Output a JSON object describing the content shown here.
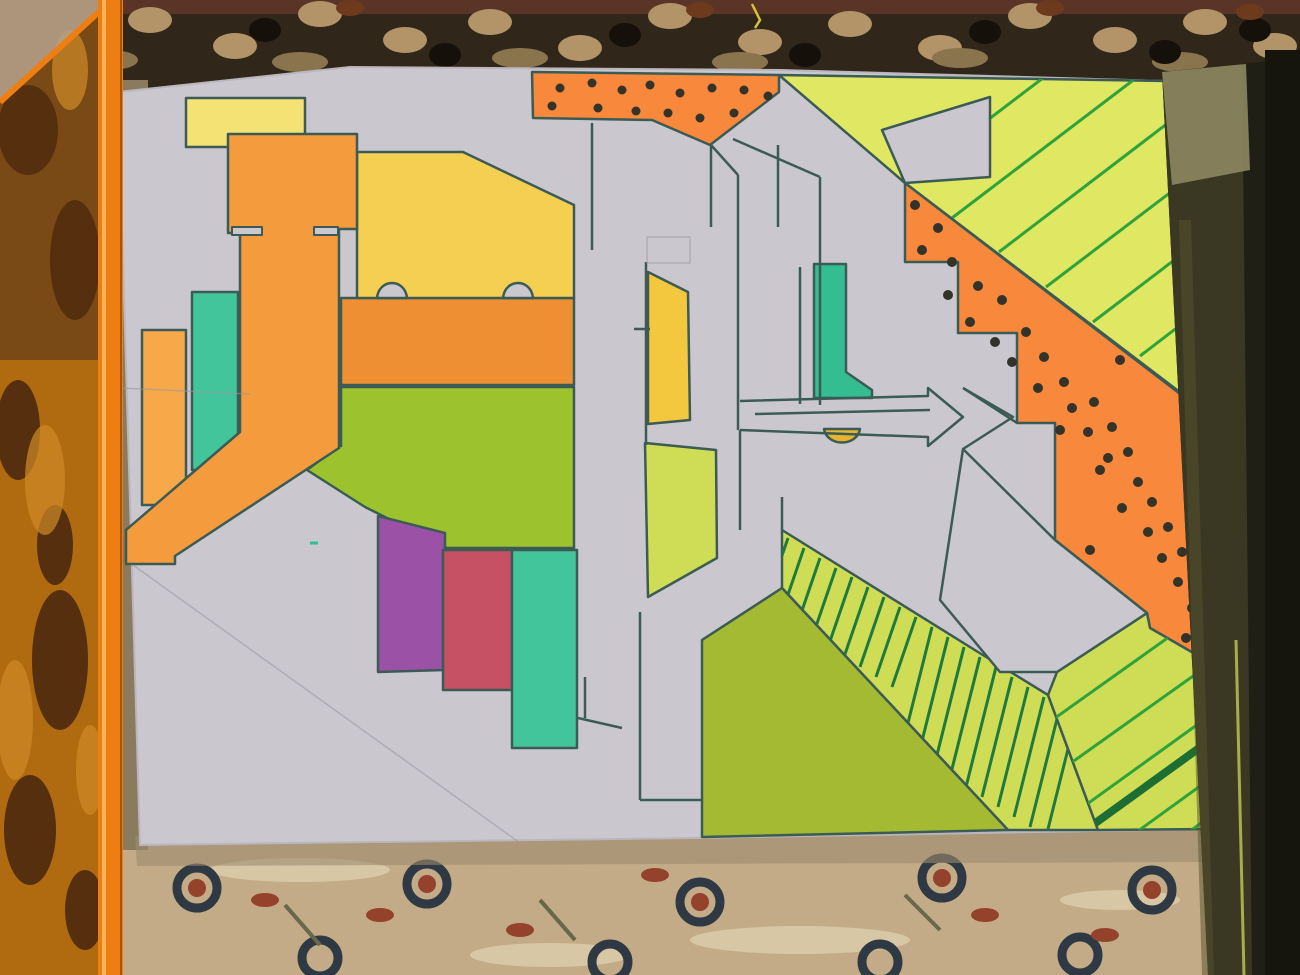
{
  "scene": {
    "type": "photograph",
    "subject": "hand-drawn abstract graffiti-style marker artwork on a white sheet of paper",
    "setting": [
      "patterned oriental carpet behind and below the paper",
      "orange transparent plastic ruler/sheet along the left edge",
      "black worn sketchbook cover along the right edge"
    ],
    "regions": [
      "letter-J-orange",
      "yellow-face-with-eyes",
      "orange-mouth-band",
      "green-chin",
      "polka-dot-orange-band-top",
      "polka-dot-orange-band-diagonal",
      "striped-chartreuse-triangle-top-right",
      "striped-chartreuse-band-bottom",
      "corner-stripes-bottom-right",
      "olive-triangle",
      "grey-letter-outlines",
      "purple-rectangle",
      "red-rectangle",
      "teal-rectangles",
      "yellow-quad",
      "gold-semicircle",
      "arrow-bar"
    ]
  },
  "colors": {
    "paper": "#cac8ce",
    "paper_edge": "#b9b6bd",
    "outline": "#3c5b54",
    "orange": "#f49b3d",
    "orange_deep": "#ee8f33",
    "orange_bright": "#f8883b",
    "orange_light": "#f7a94a",
    "yellow": "#f4cf52",
    "yellow_pale": "#f5e275",
    "yellow_deep": "#f3c83e",
    "gold": "#e6b42e",
    "apple_green": "#9cc22d",
    "chartreuse": "#dfe763",
    "chartreuse_deep": "#cedd55",
    "olive": "#a4ba33",
    "teal": "#43c59b",
    "teal_deep": "#35bd92",
    "purple": "#9b51a5",
    "red": "#c65064",
    "stripe_green": "#2fa23c",
    "stripe_dark": "#1f7a3d",
    "stripe_thick": "#1d6e33",
    "dot": "#33332a",
    "pencil": "#9a96a0",
    "carpet_top": "#30271a",
    "carpet_fringe": "#5a3426",
    "carpet_top_tan": "#b29468",
    "carpet_top_tan2": "#8a744e",
    "carpet_top_dark": "#15100a",
    "carpet_top_red": "#6e3a1e",
    "thread_yellow": "#d9c23a",
    "carpet_bottom": "#c3ab87",
    "carpet_bottom_dark": "#2e3943",
    "carpet_bottom_red": "#95422c",
    "carpet_bottom_olive": "#67694a",
    "carpet_bottom_pale": "#d8c7a5",
    "plastic": "#7a4a16",
    "plastic_lower": "#b06a10",
    "plastic_dark": "#552f0e",
    "plastic_light": "#d08a28",
    "plastic_edge": "#ee7d12",
    "plastic_edge_light": "#ffb45a",
    "plastic_edge_dark": "#a85408",
    "plastic_sheen": "#b5a28c",
    "book": "#201f15",
    "book_worn": "#3a3722",
    "book_patch": "#8d8760",
    "book_streak": "#56532f",
    "book_line": "#a7ad4b",
    "book_dark": "#15150e",
    "shadow": "#9c8a6e",
    "under_sliver": "#8a7a5e"
  }
}
